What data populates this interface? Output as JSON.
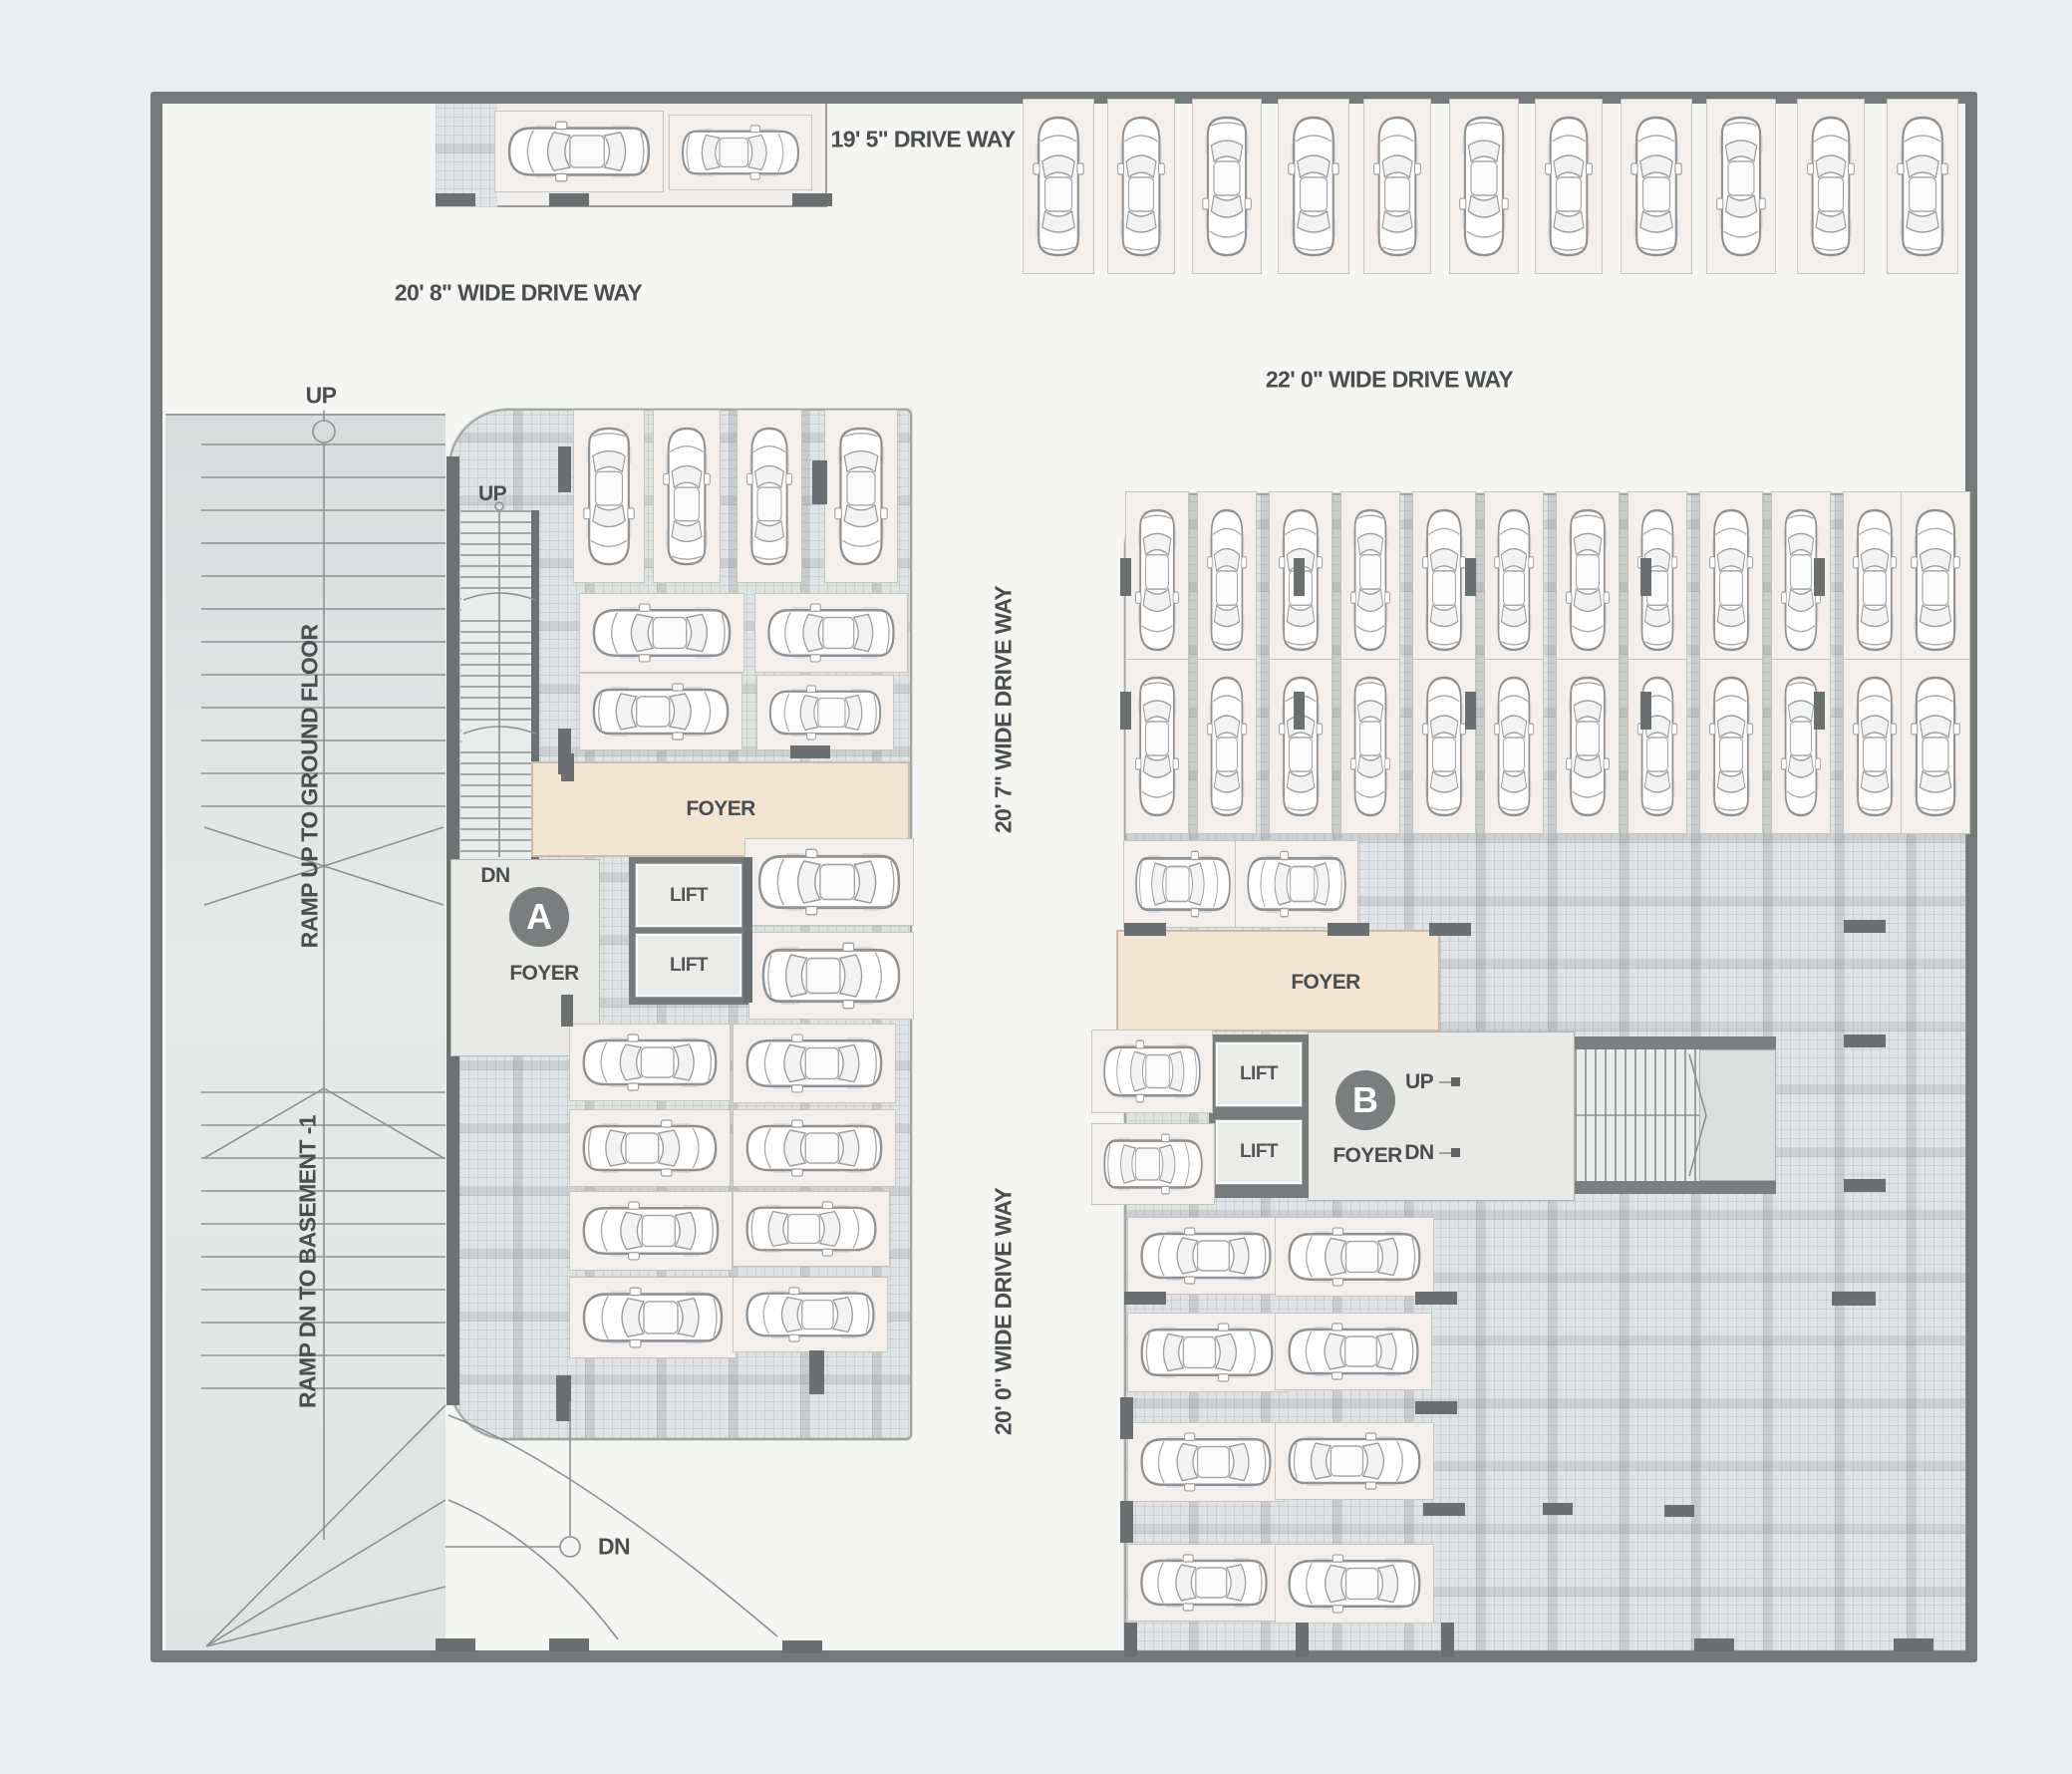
{
  "driveways": {
    "top": "19' 5\" DRIVE WAY",
    "upper_left": "20' 8\" WIDE DRIVE WAY",
    "upper_right": "22' 0\" WIDE DRIVE WAY",
    "mid_vertical": "20' 7\" WIDE DRIVE WAY",
    "lower_vertical": "20' 0\" WIDE DRIVE WAY"
  },
  "ramp": {
    "up_label": "UP",
    "down_label": "DN",
    "up_ramp_text": "RAMP UP TO GROUND FLOOR",
    "down_ramp_text": "RAMP DN TO BASEMENT -1"
  },
  "tower_a": {
    "letter": "A",
    "stair_up": "UP",
    "core_down": "DN",
    "foyer_band": "FOYER",
    "foyer_core": "FOYER",
    "lift_1": "LIFT",
    "lift_2": "LIFT"
  },
  "tower_b": {
    "letter": "B",
    "up": "UP",
    "down": "DN",
    "foyer_band": "FOYER",
    "foyer_core": "FOYER",
    "lift_1": "LIFT",
    "lift_2": "LIFT"
  },
  "colors": {
    "wall": "#75797a",
    "floor": "#f5f5f4",
    "tile": "#e0e3e3",
    "stall": "#f2efec",
    "foyer": "#f3e5d4",
    "tower_badge": "#7b7e7f",
    "text": "#4b4e4f"
  },
  "parking": {
    "car_count": 67,
    "cars": [
      [
        505,
        120,
        152,
        64,
        "h"
      ],
      [
        680,
        124,
        126,
        58,
        "h"
      ],
      [
        1035,
        112,
        54,
        150,
        "v"
      ],
      [
        1120,
        112,
        50,
        150,
        "v"
      ],
      [
        1205,
        112,
        52,
        150,
        "v"
      ],
      [
        1291,
        112,
        54,
        150,
        "v"
      ],
      [
        1377,
        112,
        50,
        150,
        "v"
      ],
      [
        1463,
        112,
        52,
        150,
        "v"
      ],
      [
        1549,
        112,
        50,
        150,
        "v"
      ],
      [
        1635,
        112,
        54,
        150,
        "v"
      ],
      [
        1721,
        112,
        52,
        150,
        "v"
      ],
      [
        1812,
        112,
        50,
        150,
        "v"
      ],
      [
        1902,
        112,
        54,
        150,
        "v"
      ],
      [
        584,
        424,
        54,
        148,
        "v"
      ],
      [
        664,
        424,
        50,
        148,
        "v"
      ],
      [
        748,
        424,
        48,
        148,
        "v"
      ],
      [
        836,
        424,
        56,
        148,
        "v"
      ],
      [
        590,
        604,
        148,
        62,
        "h"
      ],
      [
        766,
        604,
        136,
        62,
        "h"
      ],
      [
        590,
        684,
        146,
        60,
        "h"
      ],
      [
        768,
        686,
        120,
        58,
        "h"
      ],
      [
        756,
        850,
        152,
        70,
        "h"
      ],
      [
        760,
        944,
        148,
        70,
        "h"
      ],
      [
        580,
        1036,
        144,
        60,
        "h"
      ],
      [
        744,
        1036,
        146,
        62,
        "h"
      ],
      [
        580,
        1122,
        144,
        60,
        "h"
      ],
      [
        744,
        1122,
        146,
        60,
        "h"
      ],
      [
        580,
        1204,
        146,
        62,
        "h"
      ],
      [
        744,
        1204,
        140,
        58,
        "h"
      ],
      [
        580,
        1290,
        150,
        64,
        "h"
      ],
      [
        744,
        1290,
        138,
        58,
        "h"
      ],
      [
        1138,
        506,
        46,
        152,
        "v"
      ],
      [
        1210,
        506,
        42,
        152,
        "v"
      ],
      [
        1282,
        506,
        46,
        152,
        "v"
      ],
      [
        1354,
        506,
        42,
        152,
        "v"
      ],
      [
        1426,
        506,
        46,
        152,
        "v"
      ],
      [
        1498,
        506,
        42,
        152,
        "v"
      ],
      [
        1570,
        506,
        46,
        152,
        "v"
      ],
      [
        1642,
        506,
        42,
        152,
        "v"
      ],
      [
        1714,
        506,
        46,
        152,
        "v"
      ],
      [
        1786,
        506,
        42,
        152,
        "v"
      ],
      [
        1858,
        506,
        46,
        152,
        "v"
      ],
      [
        1916,
        506,
        52,
        152,
        "v"
      ],
      [
        1138,
        674,
        46,
        150,
        "v"
      ],
      [
        1210,
        674,
        42,
        150,
        "v"
      ],
      [
        1282,
        674,
        46,
        150,
        "v"
      ],
      [
        1354,
        674,
        42,
        150,
        "v"
      ],
      [
        1426,
        674,
        46,
        150,
        "v"
      ],
      [
        1498,
        674,
        42,
        150,
        "v"
      ],
      [
        1570,
        674,
        46,
        150,
        "v"
      ],
      [
        1642,
        674,
        42,
        150,
        "v"
      ],
      [
        1714,
        674,
        46,
        150,
        "v"
      ],
      [
        1786,
        674,
        42,
        150,
        "v"
      ],
      [
        1858,
        674,
        46,
        150,
        "v"
      ],
      [
        1916,
        674,
        52,
        150,
        "v"
      ],
      [
        1136,
        852,
        102,
        70,
        "h"
      ],
      [
        1248,
        852,
        106,
        70,
        "h"
      ],
      [
        1104,
        1042,
        104,
        66,
        "h"
      ],
      [
        1104,
        1136,
        106,
        64,
        "h"
      ],
      [
        1140,
        1230,
        140,
        60,
        "h"
      ],
      [
        1288,
        1230,
        142,
        62,
        "h"
      ],
      [
        1140,
        1326,
        142,
        62,
        "h"
      ],
      [
        1288,
        1326,
        140,
        60,
        "h"
      ],
      [
        1140,
        1436,
        140,
        62,
        "h"
      ],
      [
        1288,
        1436,
        142,
        60,
        "h"
      ],
      [
        1140,
        1558,
        136,
        60,
        "h"
      ],
      [
        1288,
        1558,
        142,
        62,
        "h"
      ]
    ],
    "columns": [
      [
        437,
        194,
        40,
        13
      ],
      [
        551,
        194,
        40,
        13
      ],
      [
        795,
        194,
        40,
        13
      ],
      [
        560,
        448,
        13,
        46
      ],
      [
        815,
        462,
        15,
        44
      ],
      [
        560,
        731,
        13,
        46
      ],
      [
        563,
        756,
        13,
        28
      ],
      [
        793,
        748,
        40,
        13
      ],
      [
        746,
        860,
        9,
        146
      ],
      [
        563,
        998,
        12,
        32
      ],
      [
        558,
        1380,
        15,
        46
      ],
      [
        812,
        1355,
        15,
        44
      ],
      [
        1124,
        560,
        11,
        38
      ],
      [
        1298,
        560,
        11,
        38
      ],
      [
        1470,
        560,
        11,
        38
      ],
      [
        1646,
        560,
        11,
        38
      ],
      [
        1820,
        560,
        11,
        38
      ],
      [
        1124,
        694,
        11,
        38
      ],
      [
        1298,
        694,
        11,
        38
      ],
      [
        1470,
        694,
        11,
        38
      ],
      [
        1646,
        694,
        11,
        38
      ],
      [
        1820,
        694,
        11,
        38
      ],
      [
        1128,
        926,
        42,
        13
      ],
      [
        1332,
        926,
        42,
        13
      ],
      [
        1434,
        926,
        42,
        13
      ],
      [
        1850,
        923,
        42,
        13
      ],
      [
        1850,
        1038,
        42,
        13
      ],
      [
        1850,
        1183,
        42,
        13
      ],
      [
        1838,
        1296,
        44,
        14
      ],
      [
        1128,
        1296,
        42,
        13
      ],
      [
        1420,
        1296,
        42,
        13
      ],
      [
        1420,
        1406,
        42,
        13
      ],
      [
        1124,
        1402,
        13,
        42
      ],
      [
        1428,
        1508,
        42,
        13
      ],
      [
        1124,
        1506,
        13,
        42
      ],
      [
        1548,
        1508,
        30,
        12
      ],
      [
        1670,
        1510,
        30,
        12
      ],
      [
        437,
        1644,
        40,
        13
      ],
      [
        551,
        1644,
        40,
        13
      ],
      [
        785,
        1646,
        40,
        13
      ],
      [
        1128,
        1628,
        13,
        34
      ],
      [
        1300,
        1628,
        13,
        34
      ],
      [
        1446,
        1628,
        13,
        34
      ],
      [
        1700,
        1644,
        40,
        13
      ],
      [
        1900,
        1644,
        40,
        13
      ]
    ]
  }
}
